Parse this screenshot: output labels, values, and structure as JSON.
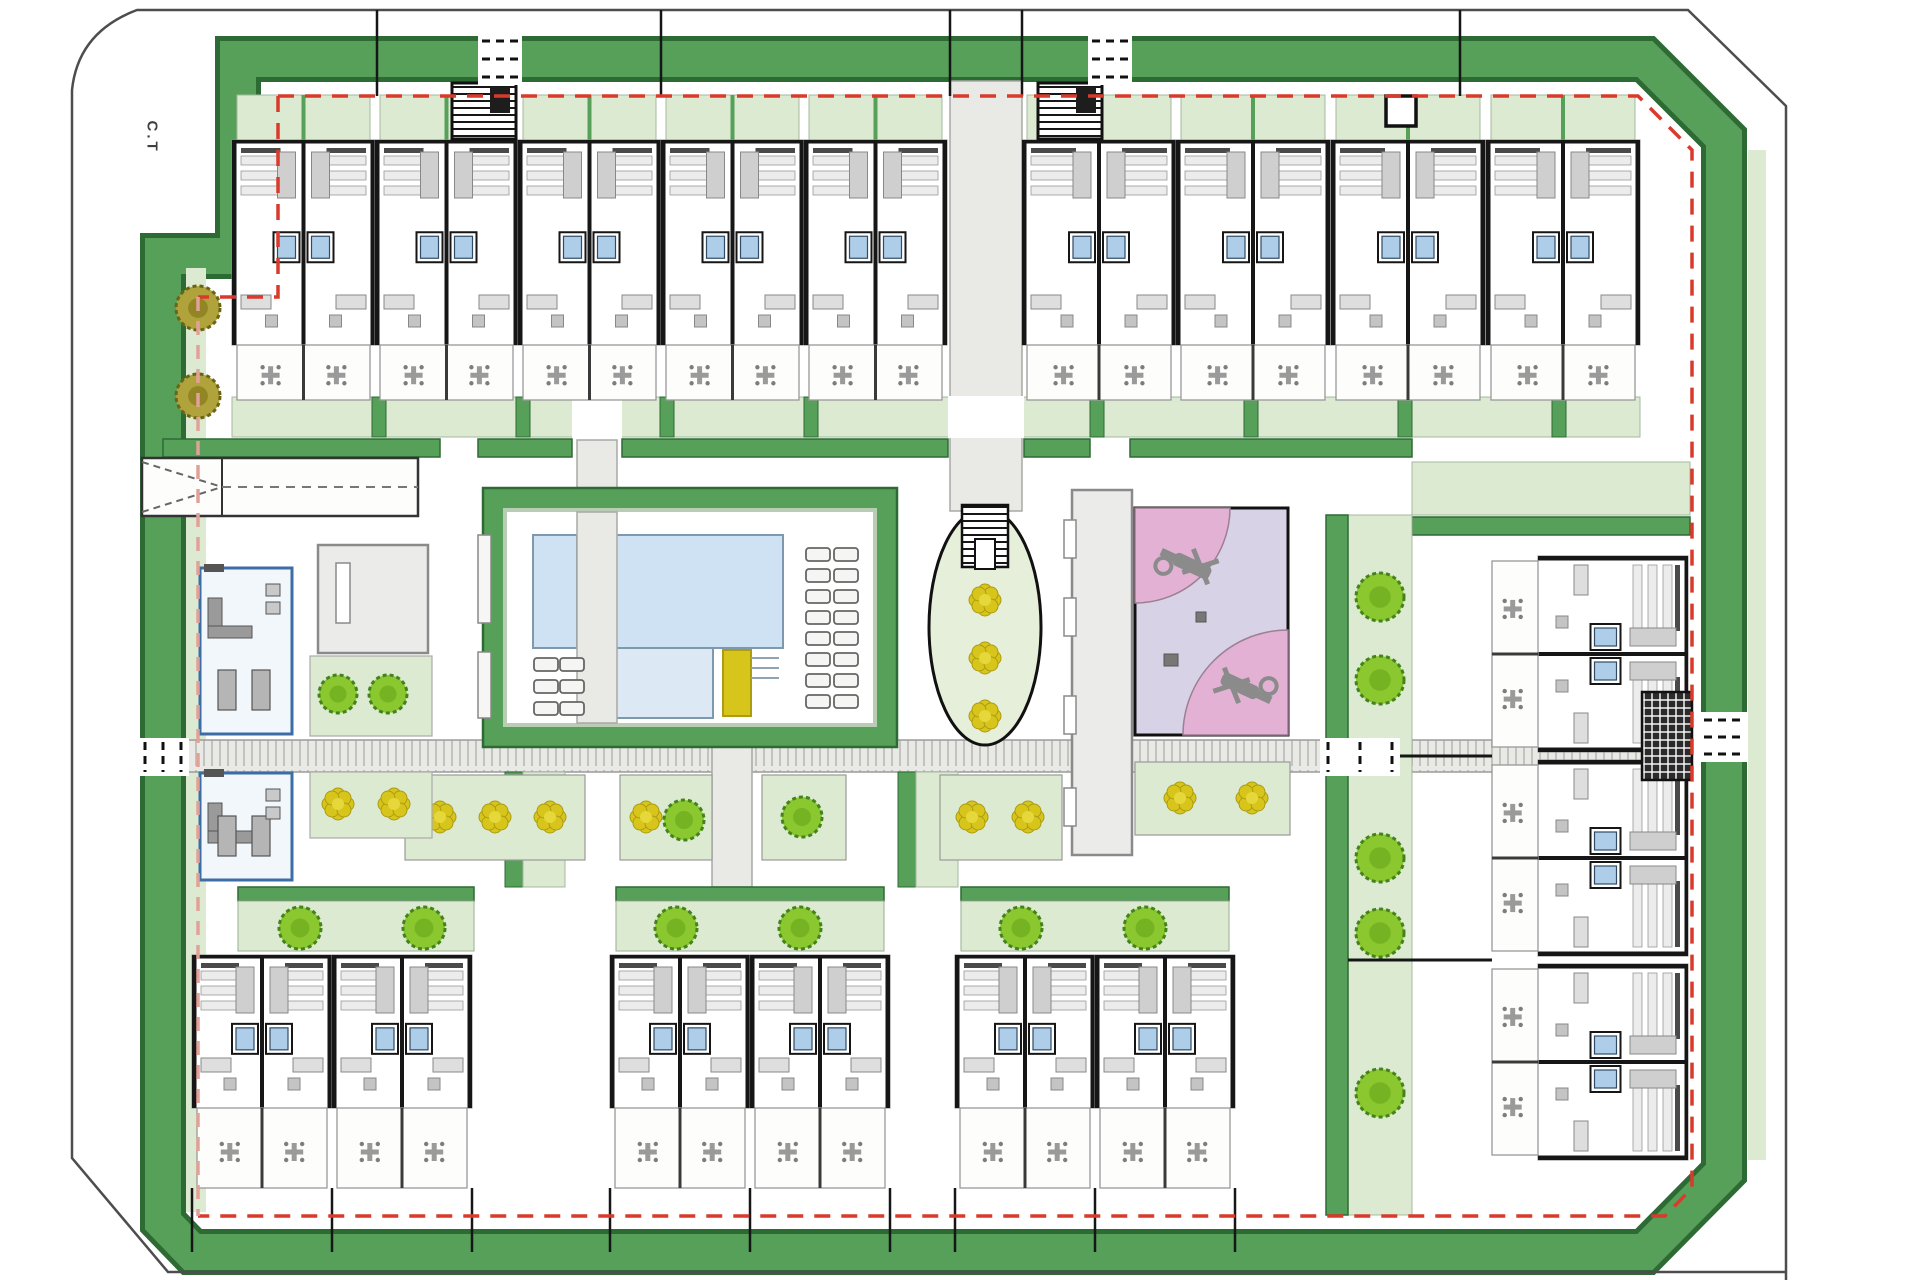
{
  "labels": {
    "ct": "C.T"
  },
  "colors": {
    "boundary": "#4d4d4d",
    "frame_dark": "#2e6b34",
    "frame_green": "#57a05a",
    "light_green": "#dcead2",
    "light_green2": "#e6efda",
    "red_dash": "#d93a2b",
    "salmon_dash": "#e2a198",
    "pool_blue": "#cfe2f3",
    "pool_blue2": "#dce9f5",
    "pool_edge": "#7e99ad",
    "yellow": "#d8c51c",
    "yellow_dark": "#ab9c10",
    "pink": "#e3b1d4",
    "lavender": "#d7d2e5",
    "tree": "#8bc72e",
    "tree_edge": "#44831c",
    "olive": "#b0a33c",
    "olive_edge": "#6b6414",
    "bld_gray": "#ebebe9",
    "bld_edge": "#8a8a8a",
    "wall": "#161616",
    "furn": "#9a9a9a",
    "furn_light": "#dedede",
    "walk": "#e9e9e6",
    "walk_edge": "#a8a8a5",
    "club_blue": "#3c6ea5",
    "club_fill": "#f2f7fc"
  },
  "boundary": {
    "path": "M1786,1280 L1786,106 L1688,10 L137,10 Q78,32 72,90 L72,1158 L168,1272 L1786,1272"
  },
  "frame": {
    "path": "M238,59 H1645 L1724,138 V1172 L1645,1252 H192 L163,1222 V256 H238 Z",
    "outer_w": 46,
    "inner_w": 36,
    "linings": [
      [
        186,
        268,
        20,
        944
      ],
      [
        1748,
        150,
        18,
        1010
      ]
    ],
    "gaps": [
      [
        478,
        33,
        44,
        52
      ],
      [
        1088,
        33,
        44,
        52
      ],
      [
        137,
        738,
        52,
        38
      ],
      [
        1700,
        712,
        48,
        50
      ],
      [
        1320,
        738,
        80,
        38
      ]
    ]
  },
  "red_dash": {
    "main": [
      "M278,96 H1638 L1692,150 V1188 L1665,1216 H198",
      "M278,96 V297 H198"
    ],
    "salmon": "M198,297 V1216"
  },
  "corridor": [
    950,
    81,
    72,
    430
  ],
  "walkway": {
    "rect": [
      140,
      740,
      1550,
      32
    ]
  },
  "pool_walk": [
    577,
    440,
    40,
    86
  ],
  "fountain": [
    597,
    516
  ],
  "plaza_band": {
    "y": 439,
    "h": 18,
    "segments": [
      [
        163,
        277
      ],
      [
        478,
        94
      ],
      [
        622,
        326
      ],
      [
        1024,
        66
      ],
      [
        1130,
        282
      ]
    ]
  },
  "right_band": [
    1412,
    517,
    278,
    18
  ],
  "right_garden": [
    1412,
    462,
    278,
    53
  ],
  "garden_band": {
    "rect": [
      232,
      397,
      1408,
      40
    ],
    "separators": [
      372,
      516,
      660,
      804,
      1090,
      1244,
      1398,
      1552
    ],
    "sep_w": 14,
    "gaps": [
      [
        948,
        76
      ],
      [
        572,
        50
      ]
    ]
  },
  "ramp": {
    "rect": [
      142,
      458,
      276,
      58
    ],
    "apex_x": 222
  },
  "club": {
    "upper": [
      200,
      568,
      92,
      166
    ],
    "lower": [
      200,
      773,
      92,
      107
    ]
  },
  "gray_buildings": [
    [
      318,
      545,
      110,
      108
    ],
    [
      1072,
      490,
      60,
      365
    ]
  ],
  "door_slots": [
    [
      336,
      563,
      14,
      60
    ],
    [
      1064,
      520,
      12,
      38
    ],
    [
      1064,
      598,
      12,
      38
    ],
    [
      1064,
      696,
      12,
      38
    ],
    [
      1064,
      788,
      12,
      38
    ]
  ],
  "terraces": [
    {
      "rect": [
        310,
        656,
        122,
        80
      ],
      "trees": [
        [
          338,
          694
        ],
        [
          388,
          694
        ]
      ]
    },
    {
      "rect": [
        310,
        772,
        122,
        66
      ],
      "flowers": [
        [
          338,
          804
        ],
        [
          394,
          804
        ]
      ]
    }
  ],
  "flower_strips": [
    {
      "rect": [
        405,
        775,
        180,
        85
      ],
      "flowers": [
        [
          440,
          817
        ],
        [
          495,
          817
        ],
        [
          550,
          817
        ]
      ]
    },
    {
      "rect": [
        620,
        775,
        92,
        85
      ],
      "flowers": [
        [
          646,
          817
        ]
      ],
      "trees": [
        [
          684,
          820
        ]
      ]
    },
    {
      "rect": [
        762,
        775,
        84,
        85
      ],
      "trees": [
        [
          802,
          817
        ]
      ]
    },
    {
      "rect": [
        940,
        775,
        122,
        85
      ],
      "flowers": [
        [
          972,
          817
        ],
        [
          1028,
          817
        ]
      ]
    },
    {
      "rect": [
        1135,
        762,
        155,
        73
      ],
      "flowers": [
        [
          1180,
          798
        ],
        [
          1252,
          798
        ]
      ]
    }
  ],
  "vertical_strips": [
    [
      505,
      772,
      60,
      115
    ],
    [
      898,
      772,
      60,
      115
    ]
  ],
  "connector_walk": [
    712,
    735,
    40,
    152
  ],
  "tree_strip": {
    "light": [
      1348,
      515,
      64,
      700
    ],
    "dark": [
      1326,
      515,
      22,
      700
    ],
    "trees_x": 1380,
    "trees_y": [
      597,
      680,
      858,
      933,
      1093
    ]
  },
  "pool": {
    "outer": [
      495,
      500,
      390,
      235
    ],
    "water_main": [
      613,
      535,
      170,
      113
    ],
    "water_arm": [
      533,
      535,
      44,
      113
    ],
    "water_shallow": [
      613,
      648,
      100,
      70
    ],
    "steps": [
      723,
      650,
      28,
      66
    ],
    "loungers_right": {
      "x": [
        806,
        834
      ],
      "y0": 548,
      "dy": 21,
      "n": 8,
      "w": 24,
      "h": 13
    },
    "loungers_left": {
      "x": [
        534,
        560
      ],
      "y0": 658,
      "dy": 22,
      "n": 3,
      "w": 24,
      "h": 13
    },
    "planters": [
      [
        478,
        535,
        13,
        88
      ],
      [
        478,
        652,
        13,
        66
      ]
    ]
  },
  "ellipse": {
    "cx": 985,
    "cy": 627,
    "rx": 56,
    "ry": 118,
    "stairs": [
      962,
      505,
      46,
      62
    ]
  },
  "island_flowers": [
    [
      985,
      600
    ],
    [
      985,
      658
    ],
    [
      985,
      716
    ]
  ],
  "playground": {
    "rect": [
      1135,
      508,
      153,
      227
    ],
    "q1_r": 95,
    "q2_r": 105,
    "squares": [
      [
        1196,
        612,
        10,
        10
      ],
      [
        1164,
        654,
        14,
        12
      ]
    ],
    "helis": [
      [
        1192,
        566,
        25
      ],
      [
        1240,
        686,
        205
      ]
    ]
  },
  "units": {
    "top": {
      "y": 140,
      "body_h": 205,
      "terr_h": 55,
      "patio_h": 45,
      "blocks": [
        {
          "xs": [
            232,
            375,
            518,
            661,
            804
          ],
          "w": 143
        },
        {
          "xs": [
            1022,
            1176,
            1331,
            1486
          ],
          "w": 154
        }
      ]
    },
    "bottom": {
      "y": 955,
      "body_h": 153,
      "terr_h": 80,
      "clusters": [
        {
          "xs": [
            192,
            332
          ],
          "w": 140
        },
        {
          "xs": [
            610,
            750
          ],
          "w": 140
        },
        {
          "xs": [
            955,
            1095
          ],
          "w": 140
        }
      ]
    },
    "right": {
      "x_edge": 1688,
      "w": 196,
      "body_h": 150,
      "terr_h": 46,
      "ys": [
        556,
        760,
        964
      ]
    }
  },
  "planter_strips": [
    [
      238,
      887,
      236,
      64
    ],
    [
      616,
      887,
      268,
      64
    ],
    [
      961,
      887,
      268,
      64
    ]
  ],
  "planter_trees": [
    [
      300,
      928
    ],
    [
      424,
      928
    ],
    [
      676,
      928
    ],
    [
      800,
      928
    ],
    [
      1021,
      928
    ],
    [
      1145,
      928
    ]
  ],
  "bin_rooms": [
    [
      452,
      83,
      64,
      56
    ],
    [
      1038,
      83,
      64,
      56
    ]
  ],
  "black_square": [
    1386,
    96,
    30,
    30
  ],
  "utility_hatch": [
    1642,
    692,
    50,
    88
  ],
  "olive_trees": [
    [
      198,
      308
    ],
    [
      198,
      396
    ]
  ],
  "top_stub_lines": {
    "xs": [
      377,
      661,
      950,
      1022,
      1460
    ],
    "y1": 10,
    "y2": 96
  },
  "bottom_stub_lines": {
    "xs": [
      192,
      332,
      472,
      610,
      750,
      890,
      955,
      1095,
      1235
    ],
    "y1": 1188,
    "y2": 1252
  },
  "right_party_lines": [
    [
      1348,
      756,
      1492,
      756
    ],
    [
      1348,
      960,
      1492,
      960
    ]
  ]
}
